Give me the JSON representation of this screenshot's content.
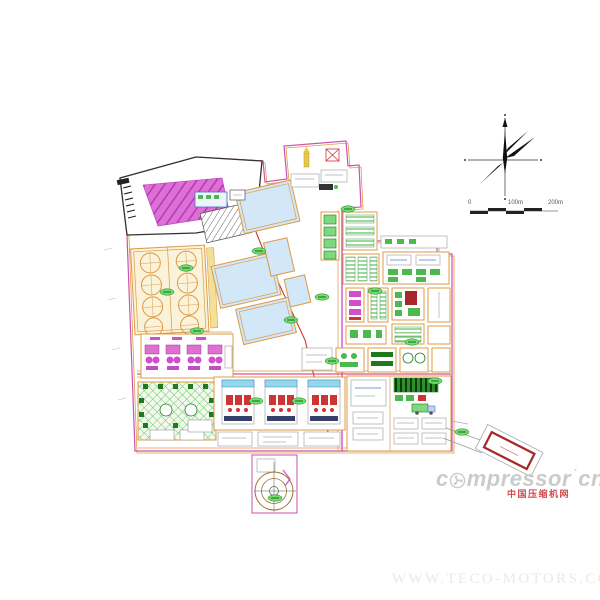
{
  "colors": {
    "boundary": "#cf4fae",
    "orange": "#dd9b44",
    "cream": "#fbf2da",
    "pond": "#d2e7f7",
    "green": "#4db84d",
    "green-bright": "#6fdf6f",
    "green-dark": "#1f7a1f",
    "magenta": "#cf4fcf",
    "magenta-fill": "#dd6fd6",
    "magenta-stripe": "#b13cb1",
    "pink": "#e06ab0",
    "red": "#cf3333",
    "darkred": "#a62828",
    "cyan": "#8fd9e8",
    "yellow": "#e6c84a",
    "blue": "#5a74c9",
    "road": "#d9538a",
    "logo": "#cbcbcb",
    "logo-red": "#d2494c",
    "footer": "#e9e9e9",
    "ink": "#333333"
  },
  "scale_bar": {
    "label_0": "0",
    "label_mid": "100m",
    "label_end": "200m"
  },
  "watermark": {
    "logo_prefix": "c",
    "logo_rest": "mpressor",
    "logo_dot": "˙",
    "logo_tld": "cn",
    "logo_sub": "中国压缩机网",
    "footer": "WWW.TECO-MOTORS.COM"
  }
}
